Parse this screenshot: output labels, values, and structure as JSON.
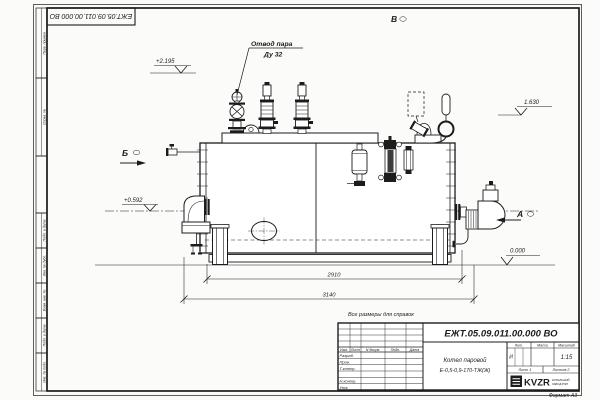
{
  "doc": {
    "number": "ЕЖТ.05.09.011.00.000  ВО",
    "format": "Формат А3",
    "note": "Все размеры для справок"
  },
  "views": {
    "a": "А",
    "b": "Б",
    "v": "В"
  },
  "elevations": {
    "valve_top": "+2.195",
    "handle_level": "1.630",
    "burner_axis": "+0.592",
    "ground": "0.000"
  },
  "dimensions": {
    "shell_length": "2910",
    "overall_length": "3140"
  },
  "callouts": {
    "steam_outlet": "Отвод пара",
    "steam_outlet_dn": "Ду 32"
  },
  "margin_labels": {
    "b1": "Перв. примен.",
    "b2": "Справ. №",
    "b3": "Подп. и дата",
    "b4": "Инв. № дубл.",
    "b5": "Взам. инв. №",
    "b6": "Подп. и дата",
    "b7": "Инв. № подл."
  },
  "title_block": {
    "doc_number": "ЕЖТ.05.09.011.00.000  ВО",
    "name1": "Котел паровой",
    "name2": "Е-0,5-0,9-170-ТЖ(Ж)",
    "col_izm": "Изм.",
    "col_list": "Лист",
    "col_doc": "N докум.",
    "col_podp": "Подп.",
    "col_data": "Дата",
    "row1": "Разраб.",
    "row2": "Пров.",
    "row3": "Т.контр.",
    "row4": "Н.контр.",
    "row5": "Утв.",
    "lit_label": "Лит.",
    "lit_value": "И",
    "mass_label": "Масса",
    "scale_label": "Масштаб",
    "scale_value": "1:15",
    "sheet": "Лист 1",
    "sheets": "Листов 2",
    "brand": "KVZR",
    "brand_line1": "КОТЕЛЬНЫЙ",
    "brand_line2": "ЗАВОД РЭП"
  }
}
